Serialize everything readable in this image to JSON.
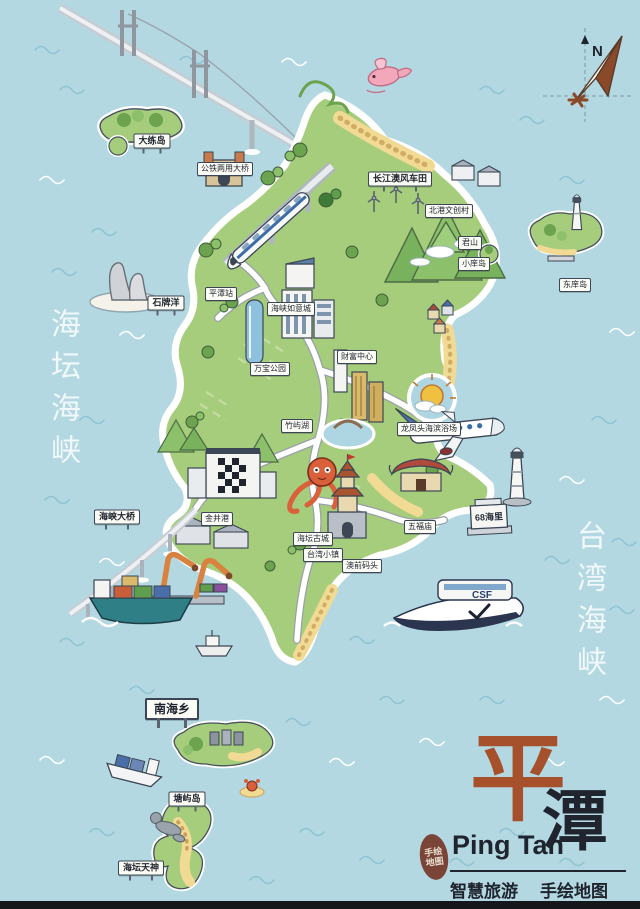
{
  "sea_labels": {
    "left": "海坛海峡",
    "right": "台湾海峡"
  },
  "compass": {
    "north_label": "N"
  },
  "scene": {
    "monument_text": "68海里",
    "ferry_text": "CSF"
  },
  "map_labels": [
    {
      "text": "大练岛",
      "x": 152,
      "y": 141,
      "variant": "billboard"
    },
    {
      "text": "公铁两用大桥",
      "x": 225,
      "y": 169,
      "variant": ""
    },
    {
      "text": "长江澳风车田",
      "x": 400,
      "y": 179,
      "variant": "billboard"
    },
    {
      "text": "北港文创村",
      "x": 449,
      "y": 211,
      "variant": ""
    },
    {
      "text": "君山",
      "x": 470,
      "y": 243,
      "variant": ""
    },
    {
      "text": "小庠岛",
      "x": 474,
      "y": 264,
      "variant": ""
    },
    {
      "text": "东庠岛",
      "x": 575,
      "y": 285,
      "variant": ""
    },
    {
      "text": "石牌洋",
      "x": 166,
      "y": 303,
      "variant": "billboard"
    },
    {
      "text": "平潭站",
      "x": 221,
      "y": 294,
      "variant": ""
    },
    {
      "text": "海峡如意城",
      "x": 291,
      "y": 309,
      "variant": ""
    },
    {
      "text": "万宝公园",
      "x": 270,
      "y": 369,
      "variant": ""
    },
    {
      "text": "财富中心",
      "x": 357,
      "y": 357,
      "variant": ""
    },
    {
      "text": "竹屿湖",
      "x": 297,
      "y": 426,
      "variant": ""
    },
    {
      "text": "龙凤头海滨浴场",
      "x": 429,
      "y": 429,
      "variant": ""
    },
    {
      "text": "海坛古城",
      "x": 313,
      "y": 539,
      "variant": ""
    },
    {
      "text": "五福庙",
      "x": 420,
      "y": 527,
      "variant": ""
    },
    {
      "text": "台湾小镇",
      "x": 323,
      "y": 555,
      "variant": ""
    },
    {
      "text": "澳前码头",
      "x": 362,
      "y": 566,
      "variant": ""
    },
    {
      "text": "海峡大桥",
      "x": 117,
      "y": 517,
      "variant": "billboard"
    },
    {
      "text": "金井港",
      "x": 217,
      "y": 519,
      "variant": ""
    },
    {
      "text": "南海乡",
      "x": 172,
      "y": 709,
      "variant": "billboard-lg"
    },
    {
      "text": "塘屿岛",
      "x": 187,
      "y": 799,
      "variant": "billboard"
    },
    {
      "text": "海坛天神",
      "x": 141,
      "y": 868,
      "variant": "billboard"
    }
  ],
  "title_block": {
    "char_primary": "平",
    "char_secondary": "潭",
    "latin": "Ping Tan",
    "tag_left": "智慧旅游",
    "tag_right": "手绘地图",
    "seal_line1": "手绘",
    "seal_line2": "地图"
  },
  "colors": {
    "sea": "#b3d8e2",
    "land": "#a6cd7c",
    "accent": "#a6512b",
    "ink": "#20242e",
    "sand": "#f1da93",
    "road": "#ffffff"
  }
}
